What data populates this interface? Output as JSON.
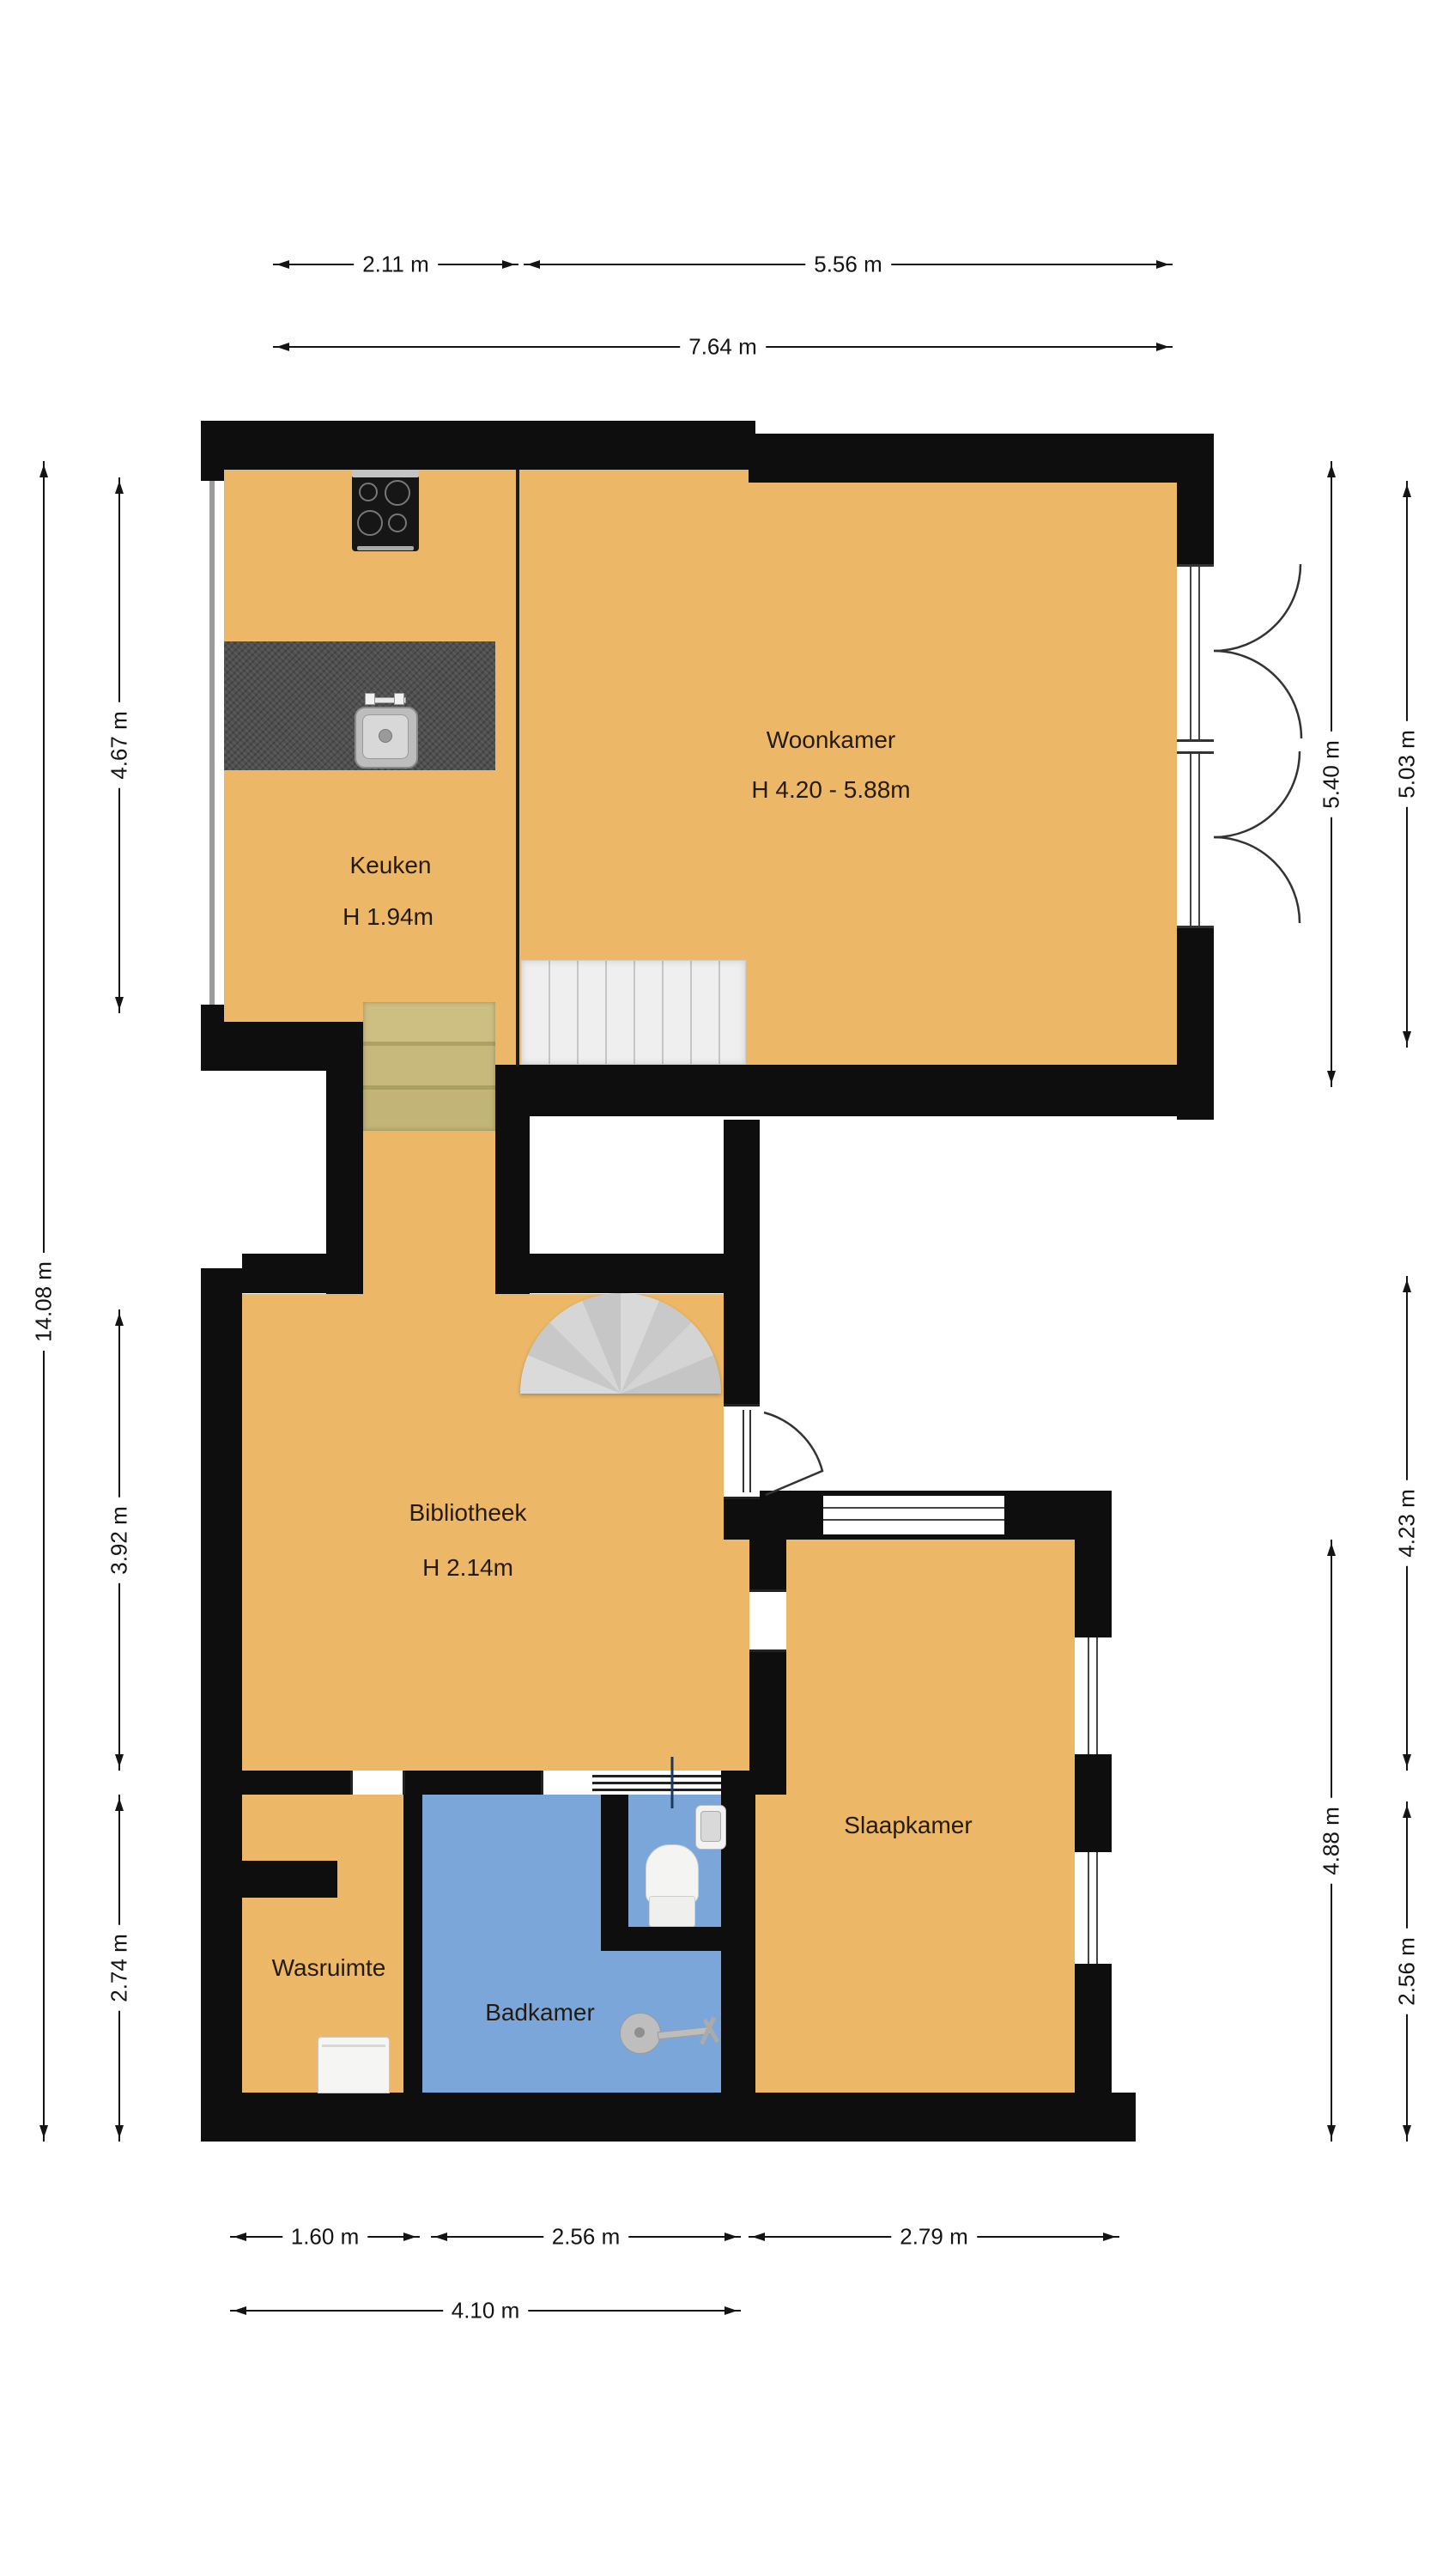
{
  "colors": {
    "floor": "#ECB767",
    "bathroom_floor": "#7BA6D9",
    "wall": "#0E0E0E",
    "counter": "#4F4F4F",
    "wood_steps": "#C9BB7D",
    "stairs": "#EDEDED",
    "stair_fan": "#D2D2D2",
    "dimension": "#141414",
    "label_text": "#241B0E"
  },
  "rooms": {
    "woonkamer": {
      "name": "Woonkamer",
      "height": "H 4.20 - 5.88m"
    },
    "keuken": {
      "name": "Keuken",
      "height": "H 1.94m"
    },
    "bibliotheek": {
      "name": "Bibliotheek",
      "height": "H 2.14m"
    },
    "slaapkamer": {
      "name": "Slaapkamer"
    },
    "wasruimte": {
      "name": "Wasruimte"
    },
    "badkamer": {
      "name": "Badkamer"
    }
  },
  "dimensions": {
    "top_keuken": "2.11 m",
    "top_woonkamer": "5.56 m",
    "top_total": "7.64 m",
    "left_total": "14.08 m",
    "left_keuken": "4.67 m",
    "left_bibliotheek": "3.92 m",
    "left_wasruimte": "2.74 m",
    "right_woonkamer_inner": "5.40 m",
    "right_woonkamer_outer": "5.03 m",
    "right_bibliotheek": "4.23 m",
    "right_slaapkamer": "4.88 m",
    "right_badkamer": "2.56 m",
    "bottom_wasruimte": "1.60 m",
    "bottom_badkamer": "2.56 m",
    "bottom_slaapkamer": "2.79 m",
    "bottom_total": "4.10 m"
  },
  "fixtures": {
    "stove": "cooktop-4-burners",
    "sink": "kitchen-sink",
    "toilet": "toilet",
    "shower": "shower-head",
    "washer": "washing-machine",
    "spiral_stairs": "spiral-staircase",
    "straight_stairs": "staircase",
    "wood_steps": "wooden-steps"
  }
}
